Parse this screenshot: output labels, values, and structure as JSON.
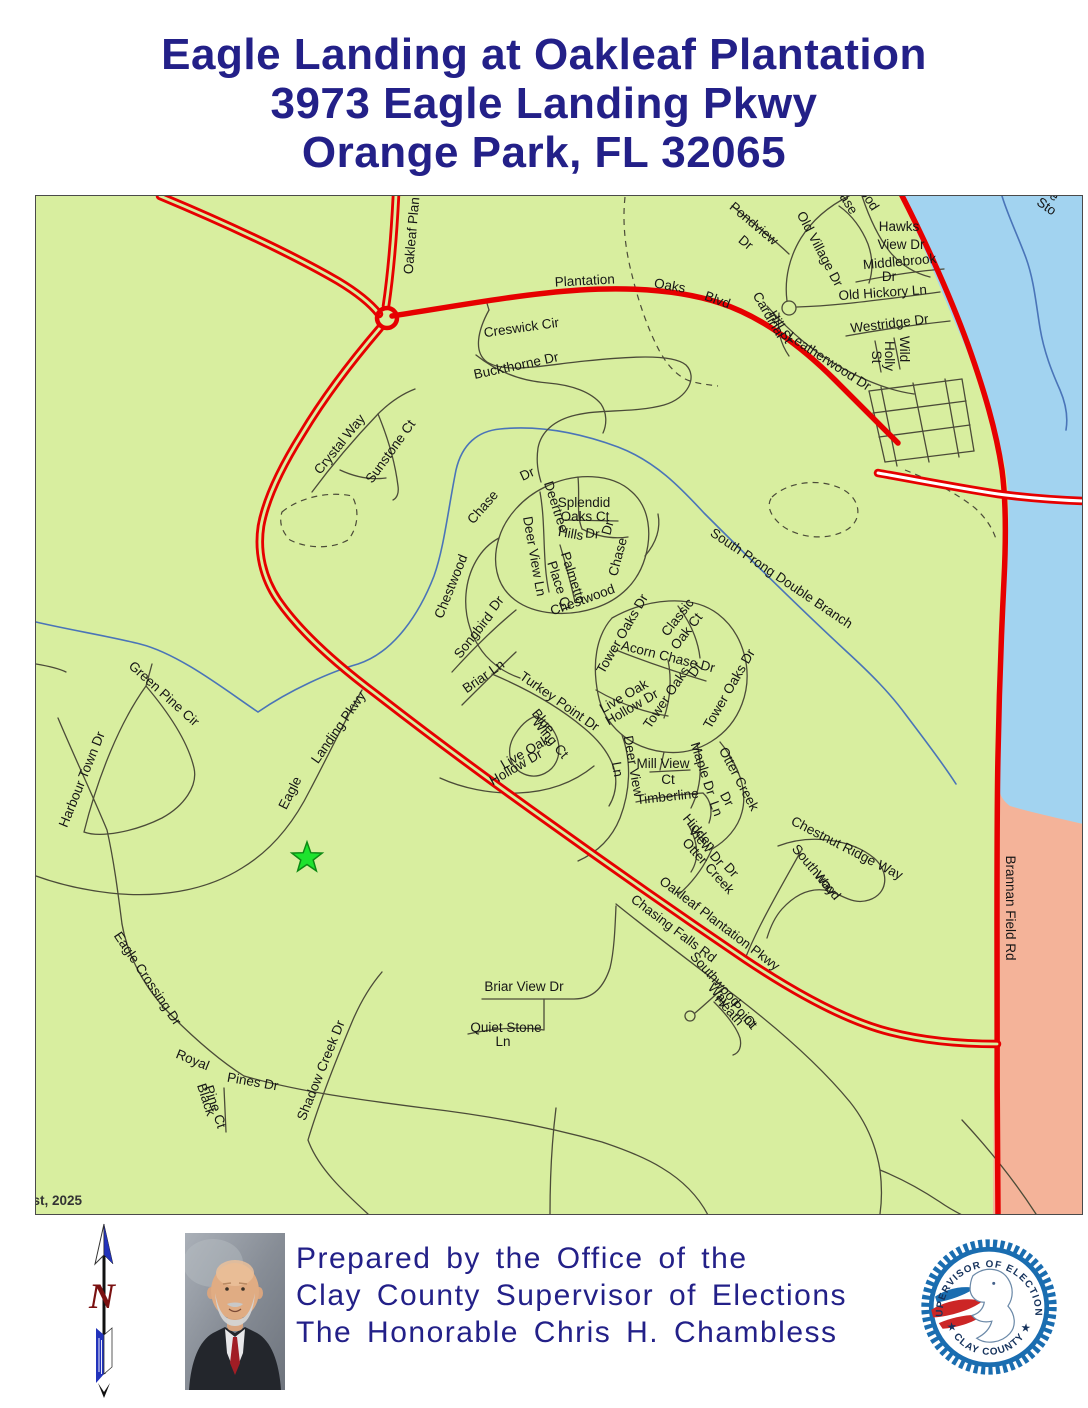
{
  "title": {
    "line1": "Eagle Landing at Oakleaf Plantation",
    "line2": "3973 Eagle Landing Pkwy",
    "line3": "Orange Park, FL 32065"
  },
  "colors": {
    "title_navy": "#232088",
    "land_green": "#d8ee9f",
    "water_blue": "#a2d3f0",
    "salmon": "#f4b399",
    "road_red": "#e60000",
    "road_minor": "#4b4b38",
    "creek_blue": "#4a74b8",
    "star_green": "#1ee32e",
    "star_outline": "#0d8a14",
    "seal_blue": "#1a6db0",
    "seal_red": "#cc2626",
    "north_red": "#7a1010"
  },
  "map": {
    "date_label": "August, 2025",
    "marker": "green-star-polling-location",
    "labels": [
      {
        "t": "Oakleaf Plan",
        "x": 416,
        "y": 236,
        "r": -85,
        "fs": 14
      },
      {
        "t": "Plantation",
        "x": 585,
        "y": 285,
        "r": -3,
        "fs": 14
      },
      {
        "t": "Oaks",
        "x": 669,
        "y": 290,
        "r": 10,
        "fs": 14
      },
      {
        "t": "Blvd",
        "x": 716,
        "y": 304,
        "r": 20,
        "fs": 14
      },
      {
        "t": "Creswick Cir",
        "x": 522,
        "y": 332,
        "r": -8
      },
      {
        "t": "Buckthorne Dr",
        "x": 517,
        "y": 370,
        "r": -12
      },
      {
        "t": "Pondview",
        "x": 751,
        "y": 227,
        "r": 40
      },
      {
        "t": "Dr",
        "x": 743,
        "y": 246,
        "r": 40
      },
      {
        "t": "Old Village Dr",
        "x": 816,
        "y": 251,
        "r": 62
      },
      {
        "t": "ase",
        "x": 845,
        "y": 206,
        "r": 58
      },
      {
        "t": "ood",
        "x": 866,
        "y": 202,
        "r": 58
      },
      {
        "t": "Hawks",
        "x": 899,
        "y": 231
      },
      {
        "t": "View Dr",
        "x": 901,
        "y": 249
      },
      {
        "t": "Middlebrook",
        "x": 900,
        "y": 266,
        "r": -5
      },
      {
        "t": "Dr",
        "x": 889,
        "y": 281
      },
      {
        "t": "Old Hickory Ln",
        "x": 883,
        "y": 297,
        "r": -4
      },
      {
        "t": "Cardinal",
        "x": 765,
        "y": 317,
        "r": 60
      },
      {
        "t": "Hill St",
        "x": 777,
        "y": 329,
        "r": 60
      },
      {
        "t": "Leatherwood Dr",
        "x": 827,
        "y": 365,
        "r": 33
      },
      {
        "t": "Westridge Dr",
        "x": 890,
        "y": 328,
        "r": -7
      },
      {
        "t": "Wild",
        "x": 900,
        "y": 349,
        "r": 90
      },
      {
        "t": "Holly",
        "x": 885,
        "y": 356,
        "r": 90
      },
      {
        "t": "St",
        "x": 872,
        "y": 357,
        "r": 90
      },
      {
        "t": "Pe",
        "x": 1048,
        "y": 197,
        "r": 35
      },
      {
        "t": "Sto",
        "x": 1044,
        "y": 210,
        "r": 35
      },
      {
        "t": "Crystal Way",
        "x": 343,
        "y": 447,
        "r": -51
      },
      {
        "t": "Sunstone Ct",
        "x": 394,
        "y": 454,
        "r": -54
      },
      {
        "t": "Chase",
        "x": 486,
        "y": 510,
        "r": -49
      },
      {
        "t": "Dr",
        "x": 529,
        "y": 478,
        "r": -25
      },
      {
        "t": "Splendid",
        "x": 584,
        "y": 507
      },
      {
        "t": "Oaks Ct",
        "x": 585,
        "y": 521
      },
      {
        "t": "Deertree",
        "x": 552,
        "y": 508,
        "r": 72
      },
      {
        "t": "Hills",
        "x": 570,
        "y": 538,
        "r": 10
      },
      {
        "t": "Dr",
        "x": 592,
        "y": 538,
        "r": 5
      },
      {
        "t": "Deer View Ln",
        "x": 530,
        "y": 557,
        "r": 80
      },
      {
        "t": "Palmetto",
        "x": 569,
        "y": 579,
        "r": 72
      },
      {
        "t": "Place Ct",
        "x": 555,
        "y": 587,
        "r": 72
      },
      {
        "t": "Chestwood",
        "x": 455,
        "y": 588,
        "r": -68
      },
      {
        "t": "Chestwood",
        "x": 584,
        "y": 604,
        "r": -20
      },
      {
        "t": "Chase",
        "x": 622,
        "y": 558,
        "r": -75
      },
      {
        "t": "Dr",
        "x": 612,
        "y": 529,
        "r": -75
      },
      {
        "t": "Songbird",
        "x": 477,
        "y": 638,
        "r": -52
      },
      {
        "t": "Dr",
        "x": 500,
        "y": 606,
        "r": -52
      },
      {
        "t": "Tower Oaks Dr",
        "x": 626,
        "y": 636,
        "r": -60
      },
      {
        "t": "Classic",
        "x": 681,
        "y": 620,
        "r": -52
      },
      {
        "t": "Oak Ct",
        "x": 690,
        "y": 634,
        "r": -52
      },
      {
        "t": "Acorn Chase Dr",
        "x": 667,
        "y": 661,
        "r": 14
      },
      {
        "t": "Tower Oaks",
        "x": 670,
        "y": 700,
        "r": -56
      },
      {
        "t": "Dr",
        "x": 699,
        "y": 672,
        "r": -56
      },
      {
        "t": "Tower Oaks Dr",
        "x": 733,
        "y": 691,
        "r": -60
      },
      {
        "t": "Live Oak",
        "x": 626,
        "y": 700,
        "r": -30
      },
      {
        "t": "Hollow Dr",
        "x": 634,
        "y": 711,
        "r": -30
      },
      {
        "t": "Briar Ln",
        "x": 486,
        "y": 680,
        "r": -35
      },
      {
        "t": "Turkey Point Dr",
        "x": 557,
        "y": 705,
        "r": 35
      },
      {
        "t": "Blue",
        "x": 540,
        "y": 724,
        "r": 50
      },
      {
        "t": "Wing Ct",
        "x": 547,
        "y": 741,
        "r": 50
      },
      {
        "t": "Live Oak",
        "x": 527,
        "y": 756,
        "r": -30
      },
      {
        "t": "Hollow Dr",
        "x": 518,
        "y": 771,
        "r": -30
      },
      {
        "t": "Deer View",
        "x": 629,
        "y": 767,
        "r": 80
      },
      {
        "t": "Ln",
        "x": 613,
        "y": 770,
        "r": 80
      },
      {
        "t": "Mill View",
        "x": 663,
        "y": 768
      },
      {
        "t": "Ct",
        "x": 668,
        "y": 784
      },
      {
        "t": "Maple Dr",
        "x": 699,
        "y": 770,
        "r": 72
      },
      {
        "t": "Otter Creek",
        "x": 735,
        "y": 781,
        "r": 62
      },
      {
        "t": "Dr",
        "x": 723,
        "y": 801,
        "r": 62
      },
      {
        "t": "Timberline",
        "x": 668,
        "y": 801,
        "r": -6
      },
      {
        "t": "Ln",
        "x": 712,
        "y": 810,
        "r": 70
      },
      {
        "t": "Hidden",
        "x": 696,
        "y": 835,
        "r": 50
      },
      {
        "t": "View Dr",
        "x": 703,
        "y": 849,
        "r": 50
      },
      {
        "t": "Otter Creek",
        "x": 705,
        "y": 869,
        "r": 48
      },
      {
        "t": "Dr",
        "x": 728,
        "y": 873,
        "r": 48
      },
      {
        "t": "South Prong Double Branch",
        "x": 779,
        "y": 582,
        "r": 34,
        "fs": 14
      },
      {
        "t": "Chestnut Ridge Way",
        "x": 845,
        "y": 852,
        "r": 27
      },
      {
        "t": "Southwood",
        "x": 813,
        "y": 875,
        "r": 50
      },
      {
        "t": "Way",
        "x": 822,
        "y": 886,
        "r": 50
      },
      {
        "t": "Brannan Field  Rd",
        "x": 1006,
        "y": 908,
        "r": 90,
        "fs": 14
      },
      {
        "t": "Oakleaf Plantation Pkwy",
        "x": 717,
        "y": 927,
        "r": 37,
        "fs": 14
      },
      {
        "t": "Chasing Falls Rd",
        "x": 671,
        "y": 932,
        "r": 37,
        "fs": 14
      },
      {
        "t": "Southwood",
        "x": 712,
        "y": 982,
        "r": 48
      },
      {
        "t": "Way",
        "x": 716,
        "y": 998,
        "r": 48
      },
      {
        "t": "Heath",
        "x": 726,
        "y": 1013,
        "r": 48
      },
      {
        "t": "Point",
        "x": 740,
        "y": 1017,
        "r": 48
      },
      {
        "t": "Ct",
        "x": 747,
        "y": 1025,
        "r": 48
      },
      {
        "t": "Briar View Dr",
        "x": 524,
        "y": 991
      },
      {
        "t": "Quiet Stone",
        "x": 506,
        "y": 1032
      },
      {
        "t": "Ln",
        "x": 503,
        "y": 1046
      },
      {
        "t": "Green Pine Cir",
        "x": 161,
        "y": 697,
        "r": 42
      },
      {
        "t": "Harbour Town Dr",
        "x": 86,
        "y": 781,
        "r": -68
      },
      {
        "t": "n",
        "x": 34,
        "y": 671,
        "r": -60
      },
      {
        "t": "Eagle",
        "x": 294,
        "y": 795,
        "r": -63
      },
      {
        "t": "Landing Pkwy",
        "x": 342,
        "y": 730,
        "r": -55
      },
      {
        "t": "Eagle Crossing Dr",
        "x": 144,
        "y": 981,
        "r": 56
      },
      {
        "t": "Royal",
        "x": 191,
        "y": 1064,
        "r": 22
      },
      {
        "t": "Pines Dr",
        "x": 252,
        "y": 1086,
        "r": 10
      },
      {
        "t": "Black",
        "x": 202,
        "y": 1101,
        "r": 72
      },
      {
        "t": "Pine Ct",
        "x": 211,
        "y": 1108,
        "r": 72
      },
      {
        "t": "Shadow Creek Dr",
        "x": 325,
        "y": 1072,
        "r": -68
      },
      {
        "t": "August, 2025",
        "x": 40,
        "y": 1205,
        "a": "start",
        "cls": "date",
        "fs": 12
      }
    ]
  },
  "footer": {
    "prepared_line1": "Prepared by the Office of the",
    "prepared_line2": "Clay County Supervisor of Elections",
    "prepared_line3": "The Honorable Chris H. Chambless",
    "north_letter": "N",
    "seal_top": "SUPERVISOR OF ELECTIONS",
    "seal_bottom": "★ CLAY COUNTY ★"
  }
}
